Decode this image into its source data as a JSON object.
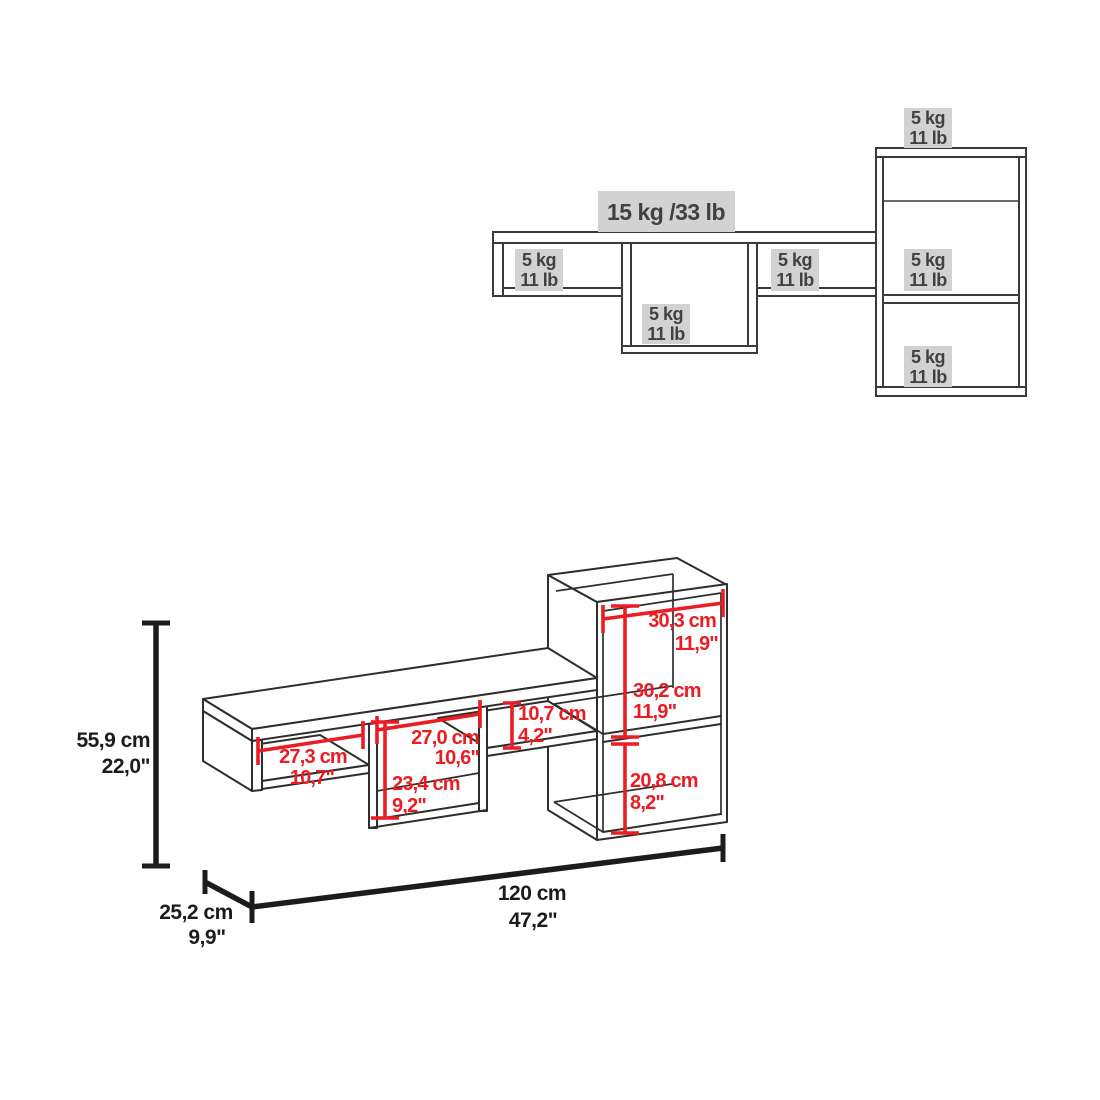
{
  "front_view": {
    "main_capacity": "15 kg /33 lb",
    "small_capacity_labels": [
      {
        "kg": "5 kg",
        "lb": "11 lb"
      },
      {
        "kg": "5 kg",
        "lb": "11 lb"
      },
      {
        "kg": "5 kg",
        "lb": "11 lb"
      },
      {
        "kg": "5 kg",
        "lb": "11 lb"
      },
      {
        "kg": "5 kg",
        "lb": "11 lb"
      },
      {
        "kg": "5 kg",
        "lb": "11 lb"
      }
    ]
  },
  "iso_view": {
    "dimensions": {
      "cabinet_width": {
        "cm": "30,3 cm",
        "inch": "11,9\""
      },
      "cabinet_upper_height": {
        "cm": "30,2 cm",
        "inch": "11,9\""
      },
      "cabinet_lower_height": {
        "cm": "20,8 cm",
        "inch": "8,2\""
      },
      "left_compartment_width": {
        "cm": "27,3 cm",
        "inch": "10,7\""
      },
      "middle_compartment_width": {
        "cm": "27,0 cm",
        "inch": "10,6\""
      },
      "middle_compartment_height": {
        "cm": "23,4 cm",
        "inch": "9,2\""
      },
      "side_compartment_height": {
        "cm": "10,7 cm",
        "inch": "4,2\""
      }
    },
    "overall": {
      "height": {
        "cm": "55,9 cm",
        "inch": "22,0\""
      },
      "width": {
        "cm": "120 cm",
        "inch": "47,2\""
      },
      "depth": {
        "cm": "25,2 cm",
        "inch": "9,9\""
      }
    }
  },
  "colors": {
    "dimension_red": "#ec1c24",
    "label_background": "#d2d2d2",
    "line": "#2e2e2e"
  }
}
